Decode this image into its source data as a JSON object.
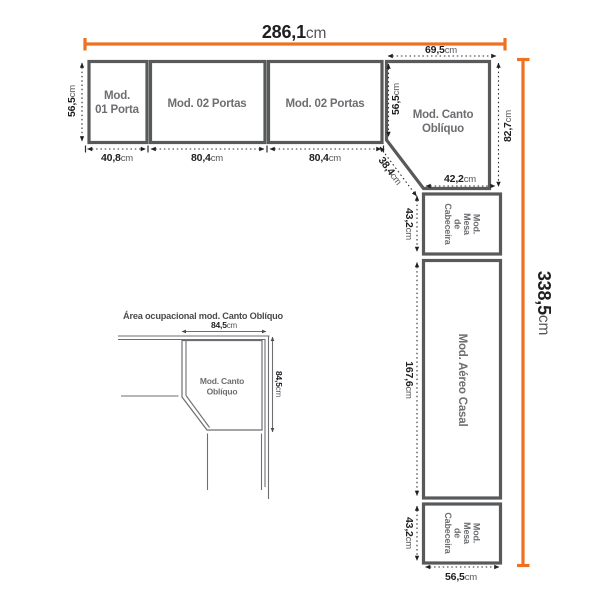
{
  "colors": {
    "accent_orange": "#ee7023",
    "module_border_gray": "#58595b",
    "module_label_gray": "#6d6e71",
    "dimension_black": "#1f1f21"
  },
  "main": {
    "total_width": {
      "value": "286,1",
      "unit": "cm"
    },
    "total_height": {
      "value": "338,5",
      "unit": "cm"
    },
    "module1": {
      "line1": "Mod.",
      "line2": "01 Porta"
    },
    "module2": {
      "label": "Mod. 02 Portas"
    },
    "module3": {
      "label": "Mod. 02 Portas"
    },
    "corner": {
      "line1": "Mod. Canto",
      "line2": "Oblíquo"
    },
    "mesa_top_label": {
      "line1": "Mod.",
      "line2": "Mesa",
      "line3": "de",
      "line4": "Cabeceira"
    },
    "aereo": {
      "label": "Mod. Aéreo Casal"
    },
    "mesa_bottom_label": {
      "line1": "Mod.",
      "line2": "Mesa",
      "line3": "de",
      "line4": "Cabeceira"
    },
    "dims": {
      "row_height": {
        "value": "56,5",
        "unit": "cm"
      },
      "m1_width": {
        "value": "40,8",
        "unit": "cm"
      },
      "m2_width": {
        "value": "80,4",
        "unit": "cm"
      },
      "m3_width": {
        "value": "80,4",
        "unit": "cm"
      },
      "corner_top": {
        "value": "69,5",
        "unit": "cm"
      },
      "corner_left": {
        "value": "56,5",
        "unit": "cm"
      },
      "corner_diag": {
        "value": "38,4",
        "unit": "cm"
      },
      "corner_bottom": {
        "value": "42,2",
        "unit": "cm"
      },
      "corner_right": {
        "value": "82,7",
        "unit": "cm"
      },
      "mesa_top_height": {
        "value": "43,2",
        "unit": "cm"
      },
      "aereo_height": {
        "value": "167,6",
        "unit": "cm"
      },
      "mesa_bottom_height": {
        "value": "43,2",
        "unit": "cm"
      },
      "column_width": {
        "value": "56,5",
        "unit": "cm"
      }
    }
  },
  "inset": {
    "title": "Área ocupacional mod. Canto Oblíquo",
    "corner": {
      "line1": "Mod. Canto",
      "line2": "Oblíquo"
    },
    "top_dim": {
      "value": "84,5",
      "unit": "cm"
    },
    "right_dim": {
      "value": "84,5",
      "unit": "cm"
    }
  }
}
